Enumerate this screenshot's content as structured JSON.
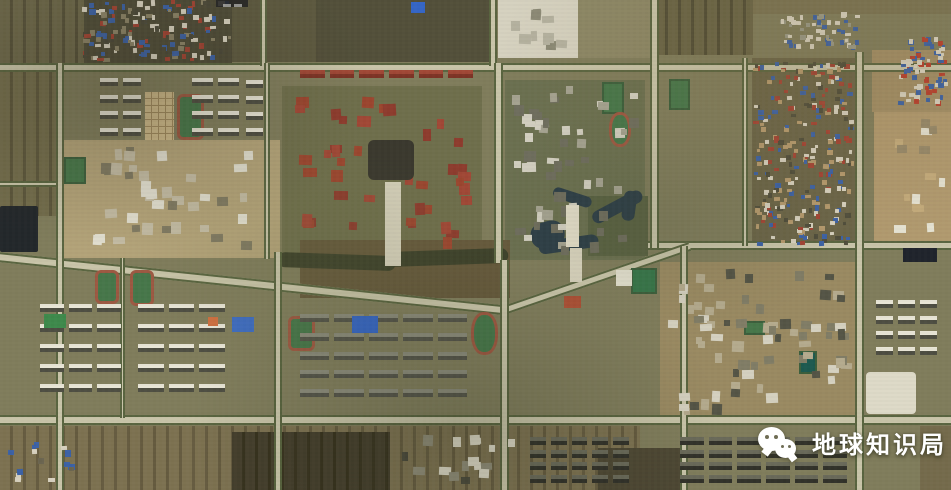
{
  "meta": {
    "kind": "satellite-imagery-screenshot",
    "width": 951,
    "height": 490
  },
  "watermark": {
    "text": "地球知识局",
    "icon": "wechat-icon",
    "color": "#ffffff"
  },
  "place_label": {
    "text": "",
    "note_color": "#262626"
  },
  "palette": {
    "base": "#807d5c",
    "road": "#c9c5a9",
    "tree_line": "#5a6540",
    "pitch_green": "#47774a",
    "track_red": "#9d5942",
    "water": "#2e3f47",
    "roof_red": "#a34434",
    "roof_blue": "#3c62a6",
    "building_white": "#e8e5d6"
  },
  "map": {
    "features": [
      {
        "t": "patch",
        "name": "farmland-top-left",
        "x": 0,
        "y": 0,
        "w": 84,
        "h": 66,
        "c": "#6d684a",
        "stripe": "#57523a"
      },
      {
        "t": "patch",
        "name": "farmland-left-edge",
        "x": 0,
        "y": 66,
        "w": 56,
        "h": 150,
        "c": "#736d4c",
        "stripe": "#5d573c"
      },
      {
        "t": "patch",
        "name": "village-ground-top-left",
        "x": 84,
        "y": 0,
        "w": 148,
        "h": 64,
        "c": "#4f4c38"
      },
      {
        "t": "patch",
        "name": "scrub-top-center-west",
        "x": 232,
        "y": 0,
        "w": 86,
        "h": 62,
        "c": "#5e5a40"
      },
      {
        "t": "patch",
        "name": "scrub-top-center",
        "x": 316,
        "y": 0,
        "w": 178,
        "h": 62,
        "c": "#53503a"
      },
      {
        "t": "patch",
        "name": "construction-site-top",
        "x": 498,
        "y": 0,
        "w": 80,
        "h": 58,
        "c": "#d6d2c0"
      },
      {
        "t": "patch",
        "name": "lot-top-center",
        "x": 578,
        "y": 0,
        "w": 72,
        "h": 58,
        "c": "#8d8866"
      },
      {
        "t": "patch",
        "name": "farmland-top-right",
        "x": 655,
        "y": 0,
        "w": 98,
        "h": 55,
        "c": "#6a6546",
        "stripe": "#524e36"
      },
      {
        "t": "patch",
        "name": "farmland-top-edge-right",
        "x": 753,
        "y": 0,
        "w": 198,
        "h": 14,
        "c": "#7b7453"
      },
      {
        "t": "patch",
        "name": "village-ground-right",
        "x": 752,
        "y": 58,
        "w": 106,
        "h": 190,
        "c": "#6b6548"
      },
      {
        "t": "patch",
        "name": "dirt-top-right-corner",
        "x": 872,
        "y": 50,
        "w": 79,
        "h": 62,
        "c": "#a28e66"
      },
      {
        "t": "patch",
        "name": "construction-right-edge",
        "x": 874,
        "y": 112,
        "w": 77,
        "h": 132,
        "c": "#b19a6f"
      },
      {
        "t": "patch",
        "name": "campus-ground-mid-left",
        "x": 58,
        "y": 140,
        "w": 222,
        "h": 118,
        "c": "#b3a379"
      },
      {
        "t": "patch",
        "name": "lawn-center-campus",
        "x": 282,
        "y": 86,
        "w": 200,
        "h": 172,
        "c": "#6f6f4c"
      },
      {
        "t": "patch",
        "name": "lawn-center-right-campus",
        "x": 505,
        "y": 80,
        "w": 140,
        "h": 180,
        "c": "#6b7050"
      },
      {
        "t": "patch",
        "name": "orchard-by-pond",
        "x": 588,
        "y": 196,
        "w": 60,
        "h": 60,
        "c": "#5a6242"
      },
      {
        "t": "patch",
        "name": "rough-ground-center",
        "x": 300,
        "y": 240,
        "w": 210,
        "h": 58,
        "c": "#665a3c"
      },
      {
        "t": "patch",
        "name": "dirt-campus-right",
        "x": 660,
        "y": 262,
        "w": 198,
        "h": 162,
        "c": "#9a8a62"
      },
      {
        "t": "patch",
        "name": "water-plot-left-edge",
        "x": 0,
        "y": 206,
        "w": 38,
        "h": 46,
        "c": "#23282b",
        "rad": 2
      },
      {
        "t": "patch",
        "name": "farmland-bottom",
        "x": 0,
        "y": 426,
        "w": 640,
        "h": 64,
        "c": "#7d7251",
        "stripe": "#665c40"
      },
      {
        "t": "patch",
        "name": "plowed-fields-bottom",
        "x": 232,
        "y": 432,
        "w": 158,
        "h": 58,
        "c": "#453f2d",
        "stripe": "#38331f"
      },
      {
        "t": "patch",
        "name": "fields-bottom-center",
        "x": 598,
        "y": 448,
        "w": 88,
        "h": 42,
        "c": "#4e4834"
      },
      {
        "t": "patch",
        "name": "farmland-bottom-right-edge",
        "x": 920,
        "y": 426,
        "w": 31,
        "h": 64,
        "c": "#756b4c"
      },
      {
        "t": "patch",
        "name": "canal-tree-band-west",
        "x": 278,
        "y": 252,
        "w": 118,
        "h": 15,
        "c": "#3e422b",
        "rad": 8,
        "rot": 2
      },
      {
        "t": "patch",
        "name": "canal-tree-band-east",
        "x": 388,
        "y": 252,
        "w": 120,
        "h": 15,
        "c": "#3e422b",
        "rad": 8,
        "rot": -2
      },
      {
        "t": "patch",
        "name": "pond-arm-west",
        "x": 538,
        "y": 242,
        "w": 60,
        "h": 13,
        "c": "#2e3f47",
        "rad": 7,
        "rot": -8
      },
      {
        "t": "patch",
        "name": "pond-arm-mid",
        "x": 590,
        "y": 214,
        "w": 55,
        "h": 13,
        "c": "#2e3f47",
        "rad": 7,
        "rot": -28
      },
      {
        "t": "patch",
        "name": "pond-arm-north",
        "x": 555,
        "y": 186,
        "w": 40,
        "h": 11,
        "c": "#2e3f47",
        "rad": 6,
        "rot": 18
      },
      {
        "t": "patch",
        "name": "pond-arm-east",
        "x": 625,
        "y": 190,
        "w": 13,
        "h": 30,
        "c": "#2e3f47",
        "rad": 6,
        "rot": 8
      },
      {
        "t": "patch",
        "name": "pond-basin",
        "x": 528,
        "y": 226,
        "w": 34,
        "h": 26,
        "c": "#2e3f47",
        "rad": 12,
        "rot": -14
      },
      {
        "t": "road",
        "name": "road-top",
        "x": 0,
        "y": 63,
        "w": 951,
        "h": 9
      },
      {
        "t": "road",
        "name": "road-left-spur",
        "x": 0,
        "y": 181,
        "w": 60,
        "h": 6
      },
      {
        "t": "road",
        "name": "road-mid-sloped",
        "x": -2,
        "y": 252,
        "w": 514,
        "h": 10,
        "rot": 6
      },
      {
        "t": "road",
        "name": "road-right-mid",
        "x": 648,
        "y": 241,
        "w": 303,
        "h": 9
      },
      {
        "t": "road",
        "name": "road-diagonal-center",
        "x": 503,
        "y": 306,
        "w": 196,
        "h": 9,
        "rot": -19
      },
      {
        "t": "road",
        "name": "road-bottom",
        "x": 0,
        "y": 415,
        "w": 951,
        "h": 10
      },
      {
        "t": "road",
        "name": "road-v-west",
        "x": 56,
        "y": 63,
        "w": 8,
        "h": 427,
        "v": 1
      },
      {
        "t": "road",
        "name": "road-v-2-top",
        "x": 260,
        "y": 0,
        "w": 7,
        "h": 66,
        "v": 1
      },
      {
        "t": "road",
        "name": "road-v-2-mid",
        "x": 264,
        "y": 63,
        "w": 6,
        "h": 196,
        "v": 1
      },
      {
        "t": "road",
        "name": "road-v-2-south",
        "x": 274,
        "y": 252,
        "w": 8,
        "h": 238,
        "v": 1
      },
      {
        "t": "road",
        "name": "road-v-minor-left",
        "x": 120,
        "y": 258,
        "w": 5,
        "h": 160,
        "v": 1
      },
      {
        "t": "road",
        "name": "road-v-3-top",
        "x": 489,
        "y": 0,
        "w": 8,
        "h": 66,
        "v": 1
      },
      {
        "t": "road",
        "name": "road-v-3-mid",
        "x": 494,
        "y": 63,
        "w": 9,
        "h": 200,
        "v": 1
      },
      {
        "t": "road",
        "name": "road-v-3-south",
        "x": 500,
        "y": 260,
        "w": 9,
        "h": 230,
        "v": 1
      },
      {
        "t": "road",
        "name": "road-v-4-north",
        "x": 650,
        "y": 0,
        "w": 9,
        "h": 248,
        "v": 1
      },
      {
        "t": "road",
        "name": "road-v-4-south",
        "x": 680,
        "y": 246,
        "w": 8,
        "h": 244,
        "v": 1
      },
      {
        "t": "road",
        "name": "road-v-village-right",
        "x": 742,
        "y": 58,
        "w": 6,
        "h": 188,
        "v": 1
      },
      {
        "t": "road",
        "name": "road-v-east",
        "x": 855,
        "y": 52,
        "w": 9,
        "h": 438,
        "v": 1
      },
      {
        "t": "grid",
        "name": "greenhouse-grid",
        "x": 145,
        "y": 92,
        "w": 29,
        "h": 48,
        "c": "#cdb98a",
        "line": "#a08a5e"
      },
      {
        "t": "field",
        "name": "stadium-track-left",
        "x": 177,
        "y": 94,
        "w": 27,
        "h": 46,
        "track": 1
      },
      {
        "t": "field",
        "name": "pitch-mid-left",
        "x": 64,
        "y": 157,
        "w": 22,
        "h": 27
      },
      {
        "t": "field",
        "name": "pitch-bottom-left-1",
        "x": 95,
        "y": 270,
        "w": 24,
        "h": 34,
        "track": 1
      },
      {
        "t": "field",
        "name": "pitch-bottom-left-2",
        "x": 130,
        "y": 270,
        "w": 24,
        "h": 36,
        "track": 1
      },
      {
        "t": "field",
        "name": "pitch-bottom-center",
        "x": 288,
        "y": 316,
        "w": 27,
        "h": 35,
        "track": 1
      },
      {
        "t": "field",
        "name": "track-oval-bottom-center",
        "x": 471,
        "y": 312,
        "w": 27,
        "h": 43,
        "track": 1,
        "oval": 1
      },
      {
        "t": "field",
        "name": "pitch-top-center-right",
        "x": 602,
        "y": 82,
        "w": 22,
        "h": 32
      },
      {
        "t": "field",
        "name": "pitch-top-right",
        "x": 669,
        "y": 79,
        "w": 21,
        "h": 31
      },
      {
        "t": "field",
        "name": "track-oval-center-right",
        "x": 609,
        "y": 112,
        "w": 22,
        "h": 35,
        "track": 1,
        "oval": 1
      },
      {
        "t": "field",
        "name": "green-courts-center",
        "x": 631,
        "y": 268,
        "w": 26,
        "h": 26,
        "c": "#37764a"
      },
      {
        "t": "field",
        "name": "pool-dark-right",
        "x": 799,
        "y": 351,
        "w": 18,
        "h": 23,
        "c": "#1e5a50"
      },
      {
        "t": "field",
        "name": "green-field-right-campus",
        "x": 744,
        "y": 321,
        "w": 21,
        "h": 14
      },
      {
        "t": "village",
        "name": "village-top-left",
        "x": 82,
        "y": 0,
        "w": 150,
        "h": 62,
        "n": 150,
        "smin": 3,
        "smax": 7,
        "pal": [
          "#d8d2c0",
          "#a34434",
          "#3c62a6",
          "#8c8468",
          "#4c4a3a"
        ],
        "seed": 11
      },
      {
        "t": "village",
        "name": "village-right",
        "x": 753,
        "y": 60,
        "w": 102,
        "h": 186,
        "n": 260,
        "smin": 3,
        "smax": 6,
        "pal": [
          "#d8d2c0",
          "#a34434",
          "#3c62a6",
          "#b59a6e",
          "#504e3c"
        ],
        "seed": 22
      },
      {
        "t": "village",
        "name": "village-top-right-corner",
        "x": 897,
        "y": 36,
        "w": 52,
        "h": 70,
        "n": 80,
        "smin": 3,
        "smax": 6,
        "pal": [
          "#b8402e",
          "#3c62a6",
          "#d8d2c0"
        ],
        "seed": 33
      },
      {
        "t": "village",
        "name": "village-top-right-blue",
        "x": 778,
        "y": 12,
        "w": 82,
        "h": 38,
        "n": 60,
        "smin": 3,
        "smax": 6,
        "pal": [
          "#3c62a6",
          "#d8d2c0",
          "#9a9a88"
        ],
        "seed": 44
      },
      {
        "t": "village",
        "name": "red-roof-campus-center",
        "x": 288,
        "y": 92,
        "w": 190,
        "h": 160,
        "n": 46,
        "smin": 7,
        "smax": 14,
        "pal": [
          "#8e3c2e",
          "#9c462f",
          "#a14836"
        ],
        "seed": 55
      },
      {
        "t": "village",
        "name": "gray-campus-center-right",
        "x": 508,
        "y": 84,
        "w": 132,
        "h": 172,
        "n": 55,
        "smin": 6,
        "smax": 12,
        "pal": [
          "#d2cfc0",
          "#a5a391",
          "#6f6e5e"
        ],
        "seed": 66
      },
      {
        "t": "village",
        "name": "campus-buildings-mid-left",
        "x": 92,
        "y": 146,
        "w": 165,
        "h": 105,
        "n": 38,
        "smin": 7,
        "smax": 13,
        "pal": [
          "#e2dfd0",
          "#c4bca4",
          "#807a62"
        ],
        "seed": 77
      },
      {
        "t": "village",
        "name": "campus-buildings-right",
        "x": 666,
        "y": 266,
        "w": 186,
        "h": 152,
        "n": 70,
        "smin": 6,
        "smax": 12,
        "pal": [
          "#b5ab8e",
          "#817d66",
          "#d5d1c0",
          "#555546"
        ],
        "seed": 88
      },
      {
        "t": "village",
        "name": "construction-buildings-right-edge",
        "x": 880,
        "y": 118,
        "w": 66,
        "h": 120,
        "n": 14,
        "smin": 6,
        "smax": 12,
        "pal": [
          "#e5e2d2",
          "#c4ab7c",
          "#97896a"
        ],
        "seed": 99
      },
      {
        "t": "village",
        "name": "buildings-bottom-center",
        "x": 396,
        "y": 432,
        "w": 128,
        "h": 54,
        "n": 16,
        "smin": 6,
        "smax": 12,
        "pal": [
          "#dcd8c6",
          "#8f8c78",
          "#4b4a3c"
        ],
        "seed": 101
      },
      {
        "t": "village",
        "name": "buildings-construction-top",
        "x": 505,
        "y": 4,
        "w": 64,
        "h": 46,
        "n": 10,
        "smin": 6,
        "smax": 12,
        "pal": [
          "#b5b2a0",
          "#8c8a76"
        ],
        "seed": 102
      },
      {
        "t": "village",
        "name": "farm-houses-bottom-left",
        "x": 6,
        "y": 440,
        "w": 80,
        "h": 44,
        "n": 14,
        "smin": 4,
        "smax": 8,
        "pal": [
          "#d8d2c0",
          "#3c62a6",
          "#6b6550"
        ],
        "seed": 103
      },
      {
        "t": "cluster",
        "name": "apartments-top-left-a",
        "x": 100,
        "y": 78,
        "w": 46,
        "h": 66,
        "r": 4,
        "co": 2
      },
      {
        "t": "cluster",
        "name": "apartments-top-left-b",
        "x": 192,
        "y": 78,
        "w": 52,
        "h": 66,
        "r": 4,
        "co": 2
      },
      {
        "t": "cluster",
        "name": "apartments-top-left-c",
        "x": 246,
        "y": 80,
        "w": 22,
        "h": 64,
        "r": 4,
        "co": 1
      },
      {
        "t": "cluster",
        "name": "red-roof-row-top-center",
        "x": 300,
        "y": 70,
        "w": 178,
        "h": 14,
        "r": 1,
        "co": 6,
        "c": "#a14836",
        "c2": "#7e3426"
      },
      {
        "t": "cluster",
        "name": "apartments-bottom-left-a",
        "x": 40,
        "y": 304,
        "w": 86,
        "h": 100,
        "r": 5,
        "co": 3
      },
      {
        "t": "cluster",
        "name": "apartments-bottom-left-b",
        "x": 138,
        "y": 304,
        "w": 92,
        "h": 100,
        "r": 5,
        "co": 3
      },
      {
        "t": "cluster",
        "name": "apartments-bottom-center",
        "x": 300,
        "y": 314,
        "w": 172,
        "h": 94,
        "r": 5,
        "co": 5,
        "c": "#8a8a7a",
        "c2": "#55554a"
      },
      {
        "t": "cluster",
        "name": "apartments-bottom-dark-a",
        "x": 530,
        "y": 437,
        "w": 104,
        "h": 50,
        "r": 4,
        "co": 5,
        "c": "#6a6a5a",
        "c2": "#32322a"
      },
      {
        "t": "cluster",
        "name": "apartments-bottom-dark-b",
        "x": 680,
        "y": 437,
        "w": 172,
        "h": 50,
        "r": 4,
        "co": 6,
        "c": "#6a6a5a",
        "c2": "#32322a"
      },
      {
        "t": "cluster",
        "name": "apartments-right-edge",
        "x": 876,
        "y": 300,
        "w": 66,
        "h": 62,
        "r": 4,
        "co": 3
      },
      {
        "t": "patch",
        "name": "main-hall-dark-center",
        "x": 368,
        "y": 140,
        "w": 46,
        "h": 40,
        "c": "#3a382e",
        "rad": 6
      },
      {
        "t": "patch",
        "name": "campus-axis-plaza",
        "x": 385,
        "y": 182,
        "w": 16,
        "h": 84,
        "c": "#d5d0ba"
      },
      {
        "t": "patch",
        "name": "axis-bridge-white",
        "x": 566,
        "y": 205,
        "w": 13,
        "h": 42,
        "c": "#e2ddc8"
      },
      {
        "t": "patch",
        "name": "axis-walk-white",
        "x": 570,
        "y": 248,
        "w": 12,
        "h": 34,
        "c": "#d8d3bd"
      },
      {
        "t": "patch",
        "name": "blue-solar-roof",
        "x": 352,
        "y": 316,
        "w": 26,
        "h": 17,
        "c": "#3566c6"
      },
      {
        "t": "patch",
        "name": "blue-roof-pair",
        "x": 232,
        "y": 317,
        "w": 22,
        "h": 15,
        "c": "#3e6cc0"
      },
      {
        "t": "patch",
        "name": "orange-building",
        "x": 208,
        "y": 317,
        "w": 10,
        "h": 9,
        "c": "#cf7040"
      },
      {
        "t": "patch",
        "name": "green-roof-building",
        "x": 44,
        "y": 314,
        "w": 22,
        "h": 14,
        "c": "#3e8a4c"
      },
      {
        "t": "patch",
        "name": "white-building-center",
        "x": 616,
        "y": 270,
        "w": 16,
        "h": 16,
        "c": "#e2dfce"
      },
      {
        "t": "patch",
        "name": "red-building-center",
        "x": 564,
        "y": 296,
        "w": 17,
        "h": 12,
        "c": "#ad5136"
      },
      {
        "t": "patch",
        "name": "big-white-building-right",
        "x": 866,
        "y": 372,
        "w": 50,
        "h": 42,
        "c": "#dedac8",
        "rad": 4
      },
      {
        "t": "patch",
        "name": "dark-solar-panels-right",
        "x": 903,
        "y": 248,
        "w": 34,
        "h": 14,
        "c": "#20242c"
      },
      {
        "t": "patch",
        "name": "blue-roof-top-center",
        "x": 411,
        "y": 2,
        "w": 14,
        "h": 11,
        "c": "#3566c6"
      }
    ]
  }
}
